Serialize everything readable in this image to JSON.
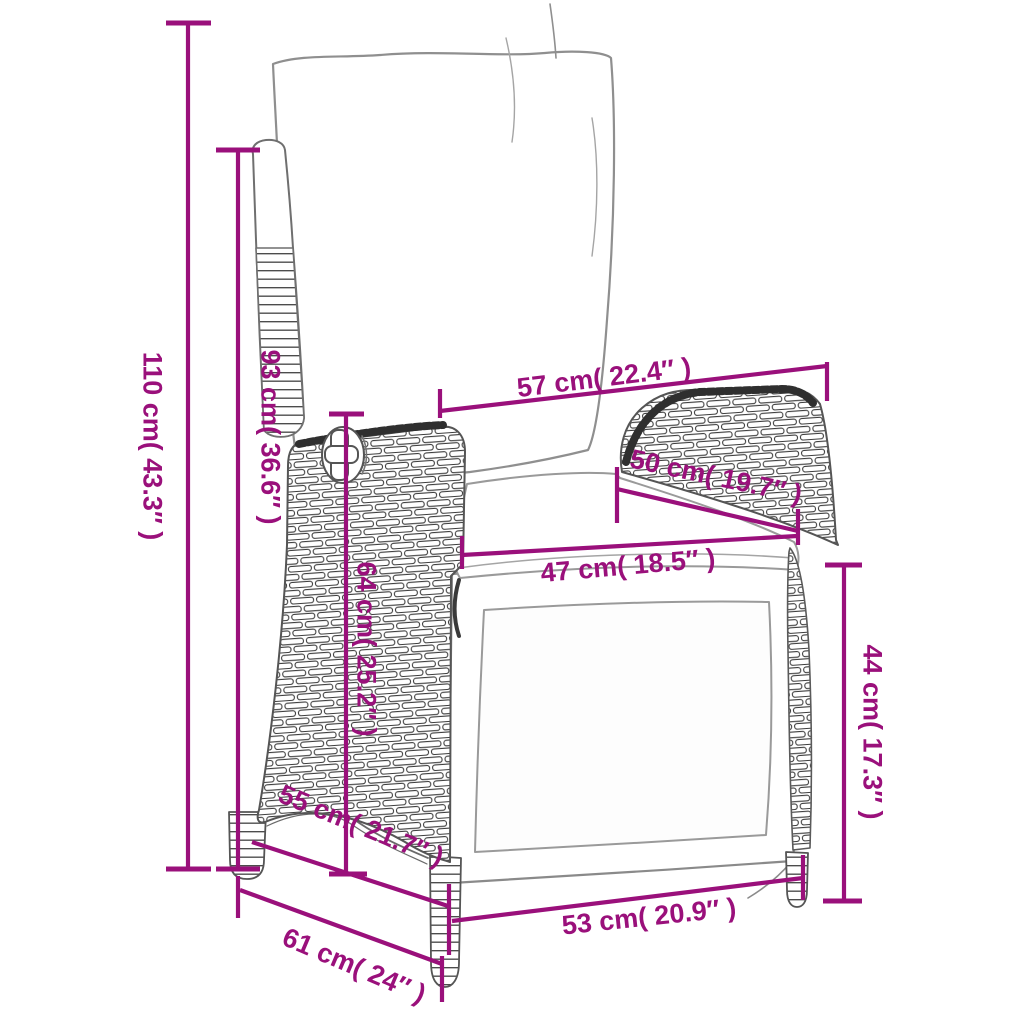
{
  "diagram": {
    "kind": "product-dimension-diagram",
    "subject": "reclining-wicker-garden-chair-sketch"
  },
  "style": {
    "dimension_color": "#9A107B",
    "background": "#ffffff"
  },
  "labels": [
    {
      "id": "total-height",
      "text": "110 cm( 43.3″ )"
    },
    {
      "id": "backrest-height",
      "text": "93 cm( 36.6″ )"
    },
    {
      "id": "back-top-width",
      "text": "57 cm( 22.4″ )"
    },
    {
      "id": "armrest-length",
      "text": "50 cm( 19.7″ )"
    },
    {
      "id": "seat-width",
      "text": "47 cm( 18.5″ )"
    },
    {
      "id": "backrest-inner-height",
      "text": "64 cm( 25.2″ )"
    },
    {
      "id": "armrest-height",
      "text": "44 cm( 17.3″ )"
    },
    {
      "id": "seat-depth",
      "text": "55 cm( 21.7″ )"
    },
    {
      "id": "base-width",
      "text": "53 cm( 20.9″ )"
    },
    {
      "id": "total-depth",
      "text": "61 cm( 24″ )"
    }
  ]
}
